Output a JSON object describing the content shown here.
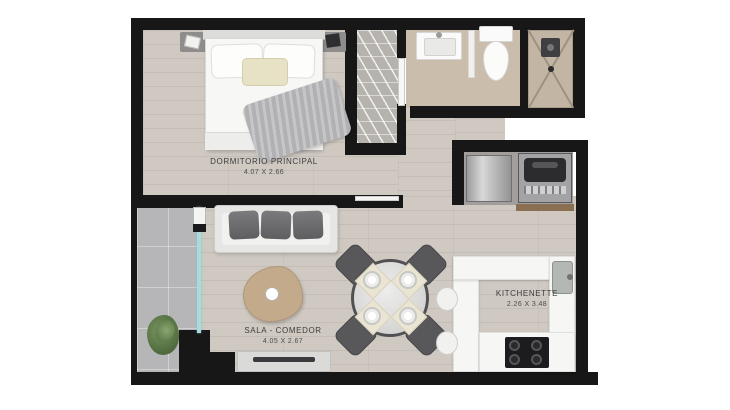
{
  "rooms": {
    "bedroom": {
      "name": "DORMITORIO PRINCIPAL",
      "dims": "4.07 X 2.66"
    },
    "living": {
      "name": "SALA - COMEDOR",
      "dims": "4.05 X 2.67"
    },
    "kitchenette": {
      "name": "KITCHENETTE",
      "dims": "2.26 X 3.48"
    }
  },
  "colors": {
    "wall": "#171717",
    "wood_floor": "#cfc9c2",
    "bath_floor": "#cabdac",
    "niche_floor": "#a29e9b",
    "balcony_floor": "#b6b6b8",
    "glass_door": "#a9dbde",
    "counter": "#f6f6f5",
    "coffee_table_wood": "#c3aa8b",
    "shelf_wood": "#8a6f52",
    "plant_green": "#5d7a49"
  }
}
